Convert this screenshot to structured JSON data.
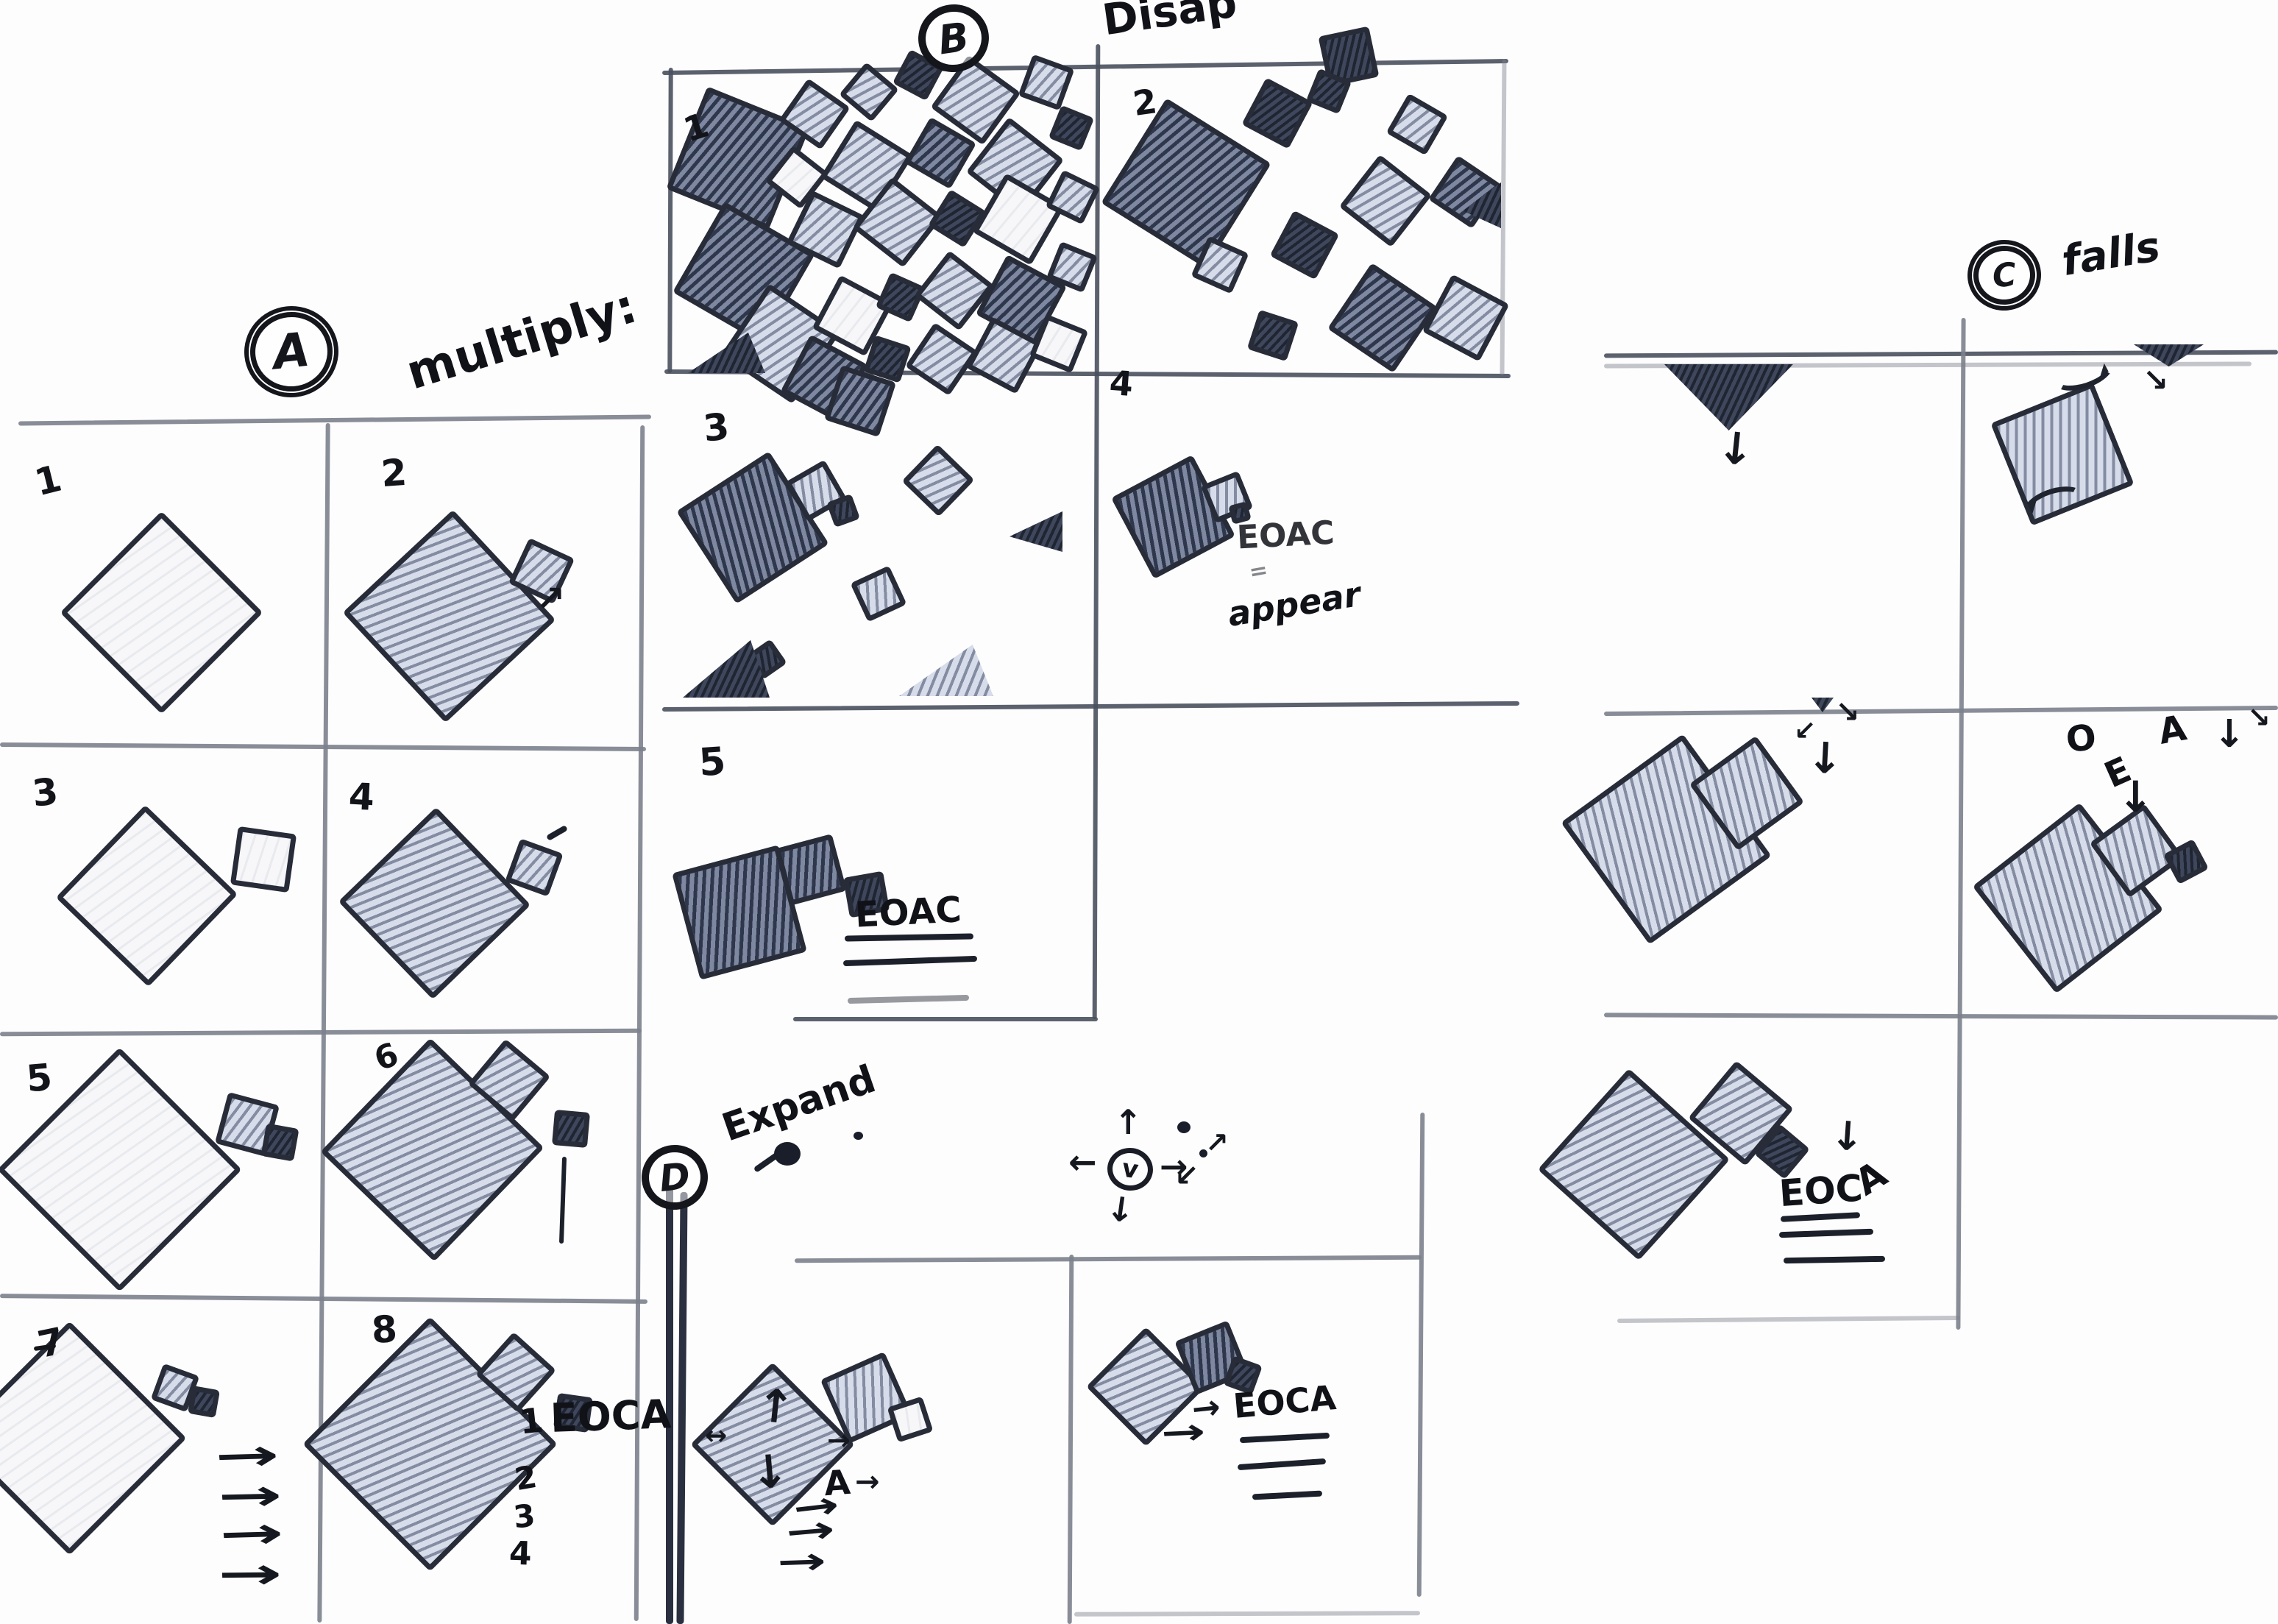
{
  "sections": {
    "a": {
      "badge": "A",
      "title": "multiply:",
      "panel_numbers": [
        "1",
        "2",
        "3",
        "4",
        "5",
        "6",
        "7",
        "8"
      ],
      "panel8": {
        "item1": "1",
        "label": "EOCA",
        "item2": "2",
        "item3": "3",
        "item4": "4"
      }
    },
    "b": {
      "badge": "B",
      "title": "Disap",
      "panel_numbers": [
        "1",
        "2",
        "3",
        "4",
        "5"
      ],
      "panel4": {
        "note": "EOAC",
        "equals": "=",
        "note2": "appear"
      },
      "panel5": {
        "note": "EOAC"
      }
    },
    "c": {
      "badge": "C",
      "title": "falls",
      "letters": {
        "o": "O",
        "e": "E",
        "a": "A"
      },
      "panel3": {
        "note_prefix": "EOC",
        "note_a": "A"
      }
    },
    "d": {
      "badge": "D",
      "title": "Expand",
      "glyph": "v",
      "panel1": {
        "label": "A"
      },
      "panel2": {
        "note": "EOCA"
      }
    }
  },
  "icons": {
    "arrow_right": "→",
    "arrow_left": "←",
    "arrow_up": "↑",
    "arrow_down": "↓",
    "arrow_up_right": "↗",
    "arrow_down_right": "↘",
    "arrow_down_left": "↙",
    "arrow_left_right": "↔"
  }
}
